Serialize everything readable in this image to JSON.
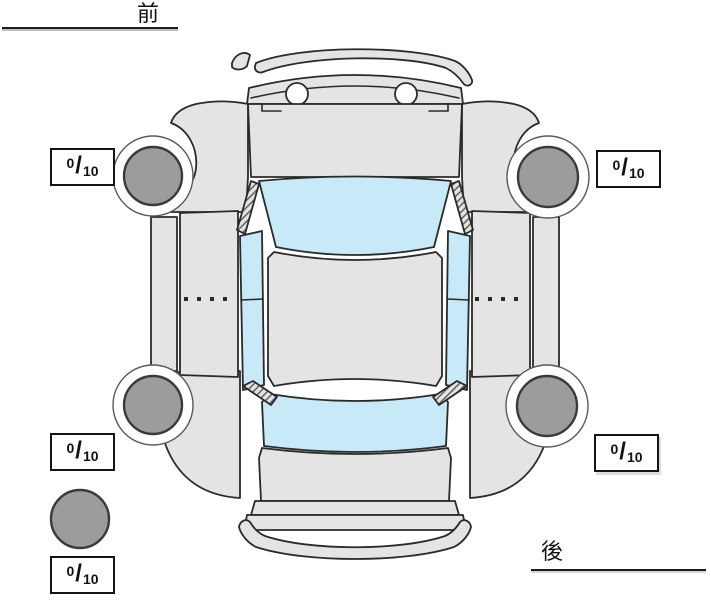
{
  "labels": {
    "front": "前",
    "rear": "後"
  },
  "tire_scores": {
    "separator": "/",
    "front_left": {
      "value": "0",
      "max": "10"
    },
    "front_right": {
      "value": "0",
      "max": "10"
    },
    "rear_left": {
      "value": "0",
      "max": "10"
    },
    "rear_right": {
      "value": "0",
      "max": "10"
    },
    "spare": {
      "value": "0",
      "max": "10"
    }
  },
  "colors": {
    "body": "#e4e4e4",
    "window": "#c7e9f8",
    "tire": "#9c9c9c",
    "outline": "#2a2a2a"
  }
}
